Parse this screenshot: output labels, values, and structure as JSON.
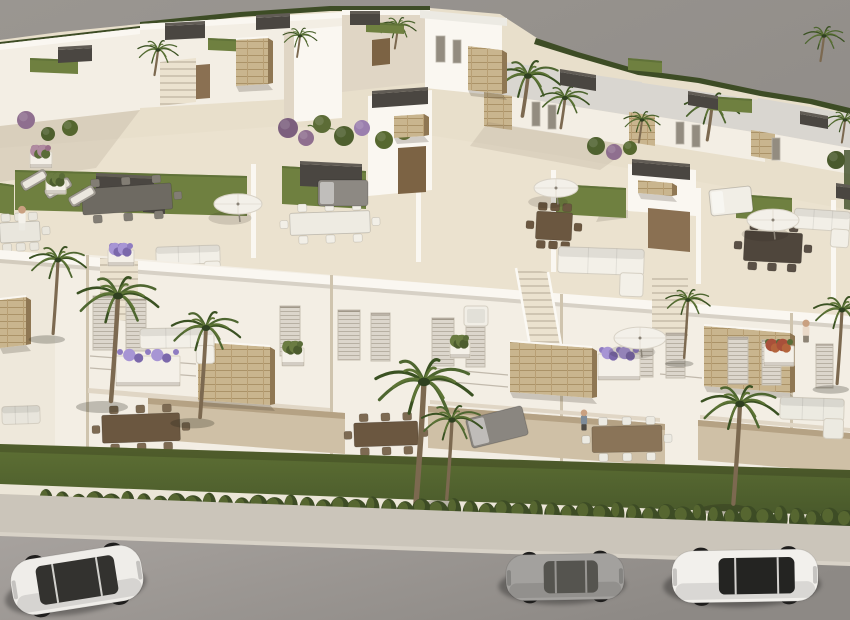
{
  "scene": {
    "description": "Aerial 3D architectural render of a modern white residential development with rooftop terraces, gardens, palm trees and three cars parked on the street below",
    "palette": {
      "bg1": "#9a9691",
      "bg2": "#8b8783",
      "base": "#e8dfcb",
      "wall": "#f3eee4",
      "wallBright": "#faf7f1",
      "wallShadow": "#e0d6c5",
      "wallDark": "#cfc4ae",
      "wedge": "#eee8db",
      "roof": "#d9d6d0",
      "roofEdge": "#eceae3",
      "boxDark": "#4a4641",
      "boxDark2": "#615c55",
      "stone": "#c9b58e",
      "stoneLine": "#ab9368",
      "stoneLine2": "#b89f74",
      "stoneSide": "#8f7753",
      "lawn": "#6f8040",
      "lawnEdge": "#5a6c34",
      "garden1": "#5e7034",
      "garden2": "#47572a",
      "hedge": "#3d4c25",
      "hedgeLight": "#5a6b33",
      "palm1": "#4e6630",
      "palm2": "#3a5122",
      "palm3": "#5d7435",
      "trunk": "#7c6950",
      "floor": "#ebe2cf",
      "stepLine": "#cfc5b2",
      "recess": "#cfc0a6",
      "recessDark": "#b5a284",
      "doorway": "#8a7052",
      "doorway2": "#7c6344",
      "win": "#dcd6cc",
      "winLine": "#b7b0a3",
      "winDark": "#938c80",
      "umbrella": "#f3f0e9",
      "umbrellaEdge": "#d8d2c6",
      "pole": "#8a8377",
      "whiteFurn": "#f1ede4",
      "grayFurn": "#8a8680",
      "wood": "#6b5740",
      "flowerPurple": "#8f7cc1",
      "flowerLight": "#a795d4",
      "flowerRed": "#a8503a",
      "potGreen": "#5a6c38",
      "road1": "#a7a29e",
      "road2": "#8d8985",
      "walk": "#cbc5ba",
      "curb": "#d8d2c7",
      "lowWall": "#ece6d8",
      "skin": "#c9a080"
    }
  },
  "objects": {
    "lawns": [
      {
        "x": 15,
        "y": 170,
        "w": 232,
        "h": 40,
        "dy": 6
      },
      {
        "x": 282,
        "y": 166,
        "w": 84,
        "h": 38,
        "dy": 5
      },
      {
        "x": 556,
        "y": 184,
        "w": 70,
        "h": 30,
        "dy": 4
      },
      {
        "x": 736,
        "y": 194,
        "w": 56,
        "h": 24,
        "dy": 4
      },
      {
        "x": 0,
        "y": 183,
        "w": 14,
        "h": 30,
        "dy": 2
      },
      {
        "x": 30,
        "y": 58,
        "w": 48,
        "h": 14,
        "dy": 2
      },
      {
        "x": 208,
        "y": 38,
        "w": 42,
        "h": 12,
        "dy": 2
      },
      {
        "x": 366,
        "y": 22,
        "w": 38,
        "h": 10,
        "dy": 2
      },
      {
        "x": 708,
        "y": 96,
        "w": 44,
        "h": 14,
        "dy": 3
      },
      {
        "x": 628,
        "y": 58,
        "w": 34,
        "h": 12,
        "dy": 3
      }
    ],
    "roof_boxes": [
      {
        "x": 96,
        "y": 176,
        "w": 58,
        "h": 18,
        "dy": 3
      },
      {
        "x": 143,
        "y": 200,
        "w": 22,
        "h": 12,
        "dy": 2
      },
      {
        "x": 300,
        "y": 164,
        "w": 62,
        "h": 22,
        "dy": 3
      },
      {
        "x": 372,
        "y": 94,
        "w": 56,
        "h": 14,
        "dy": -4
      },
      {
        "x": 632,
        "y": 162,
        "w": 58,
        "h": 13,
        "dy": 5
      },
      {
        "x": 165,
        "y": 26,
        "w": 40,
        "h": 14,
        "dy": -2
      },
      {
        "x": 256,
        "y": 18,
        "w": 34,
        "h": 12,
        "dy": -2
      },
      {
        "x": 58,
        "y": 50,
        "w": 34,
        "h": 13,
        "dy": -2
      },
      {
        "x": 350,
        "y": 14,
        "w": 30,
        "h": 11,
        "dy": 0
      },
      {
        "x": 560,
        "y": 72,
        "w": 36,
        "h": 13,
        "dy": 6
      },
      {
        "x": 688,
        "y": 94,
        "w": 30,
        "h": 11,
        "dy": 5
      },
      {
        "x": 800,
        "y": 114,
        "w": 28,
        "h": 10,
        "dy": 5
      },
      {
        "x": 836,
        "y": 186,
        "w": 14,
        "h": 12,
        "dy": 2
      }
    ],
    "stone_boxes": [
      {
        "x": 198,
        "y": 342,
        "w": 72,
        "h": 58,
        "dy": 5
      },
      {
        "x": 510,
        "y": 342,
        "w": 82,
        "h": 50,
        "dy": 6
      },
      {
        "x": 704,
        "y": 326,
        "w": 86,
        "h": 60,
        "dy": 7
      },
      {
        "x": 236,
        "y": 40,
        "w": 32,
        "h": 46,
        "dy": -2
      },
      {
        "x": 394,
        "y": 116,
        "w": 30,
        "h": 22,
        "dy": -2
      },
      {
        "x": 638,
        "y": 180,
        "w": 34,
        "h": 13,
        "dy": 3
      },
      {
        "x": 468,
        "y": 46,
        "w": 34,
        "h": 44,
        "dy": 4
      },
      {
        "x": 0,
        "y": 300,
        "w": 26,
        "h": 48,
        "dy": -3
      }
    ],
    "windows": [
      {
        "x": 93,
        "y": 296,
        "w": 22,
        "h": 54
      },
      {
        "x": 126,
        "y": 299,
        "w": 20,
        "h": 52
      },
      {
        "x": 280,
        "y": 306,
        "w": 20,
        "h": 50
      },
      {
        "x": 338,
        "y": 310,
        "w": 22,
        "h": 50
      },
      {
        "x": 371,
        "y": 313,
        "w": 19,
        "h": 48
      },
      {
        "x": 432,
        "y": 318,
        "w": 22,
        "h": 48
      },
      {
        "x": 466,
        "y": 321,
        "w": 19,
        "h": 46
      },
      {
        "x": 633,
        "y": 330,
        "w": 20,
        "h": 47
      },
      {
        "x": 666,
        "y": 333,
        "w": 19,
        "h": 45
      },
      {
        "x": 728,
        "y": 337,
        "w": 20,
        "h": 47
      },
      {
        "x": 762,
        "y": 340,
        "w": 19,
        "h": 45
      },
      {
        "x": 816,
        "y": 344,
        "w": 17,
        "h": 44
      },
      {
        "x": 436,
        "y": 36,
        "w": 9,
        "h": 26,
        "t": "dark"
      },
      {
        "x": 453,
        "y": 40,
        "w": 8,
        "h": 23,
        "t": "dark"
      },
      {
        "x": 532,
        "y": 102,
        "w": 8,
        "h": 24,
        "t": "dark"
      },
      {
        "x": 548,
        "y": 105,
        "w": 8,
        "h": 24,
        "t": "dark"
      },
      {
        "x": 676,
        "y": 122,
        "w": 8,
        "h": 22,
        "t": "dark"
      },
      {
        "x": 692,
        "y": 125,
        "w": 8,
        "h": 22,
        "t": "dark"
      },
      {
        "x": 772,
        "y": 138,
        "w": 8,
        "h": 22,
        "t": "dark"
      }
    ],
    "planters": [
      {
        "x": 116,
        "y": 356,
        "w": 64,
        "h": 30,
        "flower": "purple"
      },
      {
        "x": 598,
        "y": 354,
        "w": 42,
        "h": 26,
        "flower": "purple"
      },
      {
        "x": 764,
        "y": 346,
        "w": 30,
        "h": 20,
        "flower": "red"
      },
      {
        "x": 282,
        "y": 348,
        "w": 22,
        "h": 18,
        "flower": "green"
      },
      {
        "x": 450,
        "y": 342,
        "w": 20,
        "h": 16,
        "flower": "green"
      },
      {
        "x": 108,
        "y": 250,
        "w": 26,
        "h": 16,
        "flower": "purple"
      },
      {
        "x": 46,
        "y": 180,
        "w": 20,
        "h": 14,
        "flower": "green"
      },
      {
        "x": 30,
        "y": 152,
        "w": 22,
        "h": 16,
        "flower": "pink"
      }
    ],
    "shrubs": [
      {
        "x": 288,
        "y": 128,
        "r": 10,
        "c": "#7c5f7e"
      },
      {
        "x": 306,
        "y": 138,
        "r": 8,
        "c": "#8f6f8f"
      },
      {
        "x": 322,
        "y": 124,
        "r": 9,
        "c": "#5c6c36"
      },
      {
        "x": 344,
        "y": 136,
        "r": 10,
        "c": "#4e5f2e"
      },
      {
        "x": 362,
        "y": 128,
        "r": 8,
        "c": "#9b7fae"
      },
      {
        "x": 384,
        "y": 140,
        "r": 9,
        "c": "#56682f"
      },
      {
        "x": 404,
        "y": 132,
        "r": 8,
        "c": "#6d7b3c"
      },
      {
        "x": 596,
        "y": 146,
        "r": 9,
        "c": "#4f612f"
      },
      {
        "x": 614,
        "y": 152,
        "r": 8,
        "c": "#8f6f8f"
      },
      {
        "x": 630,
        "y": 148,
        "r": 7,
        "c": "#56682f"
      },
      {
        "x": 836,
        "y": 160,
        "r": 9,
        "c": "#4a5a2c"
      },
      {
        "x": 70,
        "y": 128,
        "r": 8,
        "c": "#55662f"
      },
      {
        "x": 26,
        "y": 120,
        "r": 9,
        "c": "#8f6f8f"
      },
      {
        "x": 48,
        "y": 134,
        "r": 7,
        "c": "#4e5f2e"
      }
    ],
    "furniture": [
      {
        "t": "dining",
        "x": 82,
        "y": 186,
        "w": 90,
        "h": 26,
        "rot": -4,
        "table": "#6e6a62",
        "chair": "#827d74",
        "layer": "roof"
      },
      {
        "t": "lounger",
        "x": 20,
        "y": 174,
        "rot": -30,
        "layer": "roof"
      },
      {
        "t": "lounger",
        "x": 44,
        "y": 182,
        "rot": -30,
        "layer": "roof"
      },
      {
        "t": "lounger",
        "x": 68,
        "y": 190,
        "rot": -30,
        "layer": "roof"
      },
      {
        "t": "dining",
        "x": 290,
        "y": 212,
        "w": 80,
        "h": 22,
        "rot": -2,
        "table": "#eeebe2",
        "chair": "#f2efe7",
        "layer": "roof"
      },
      {
        "t": "sofa",
        "x": 156,
        "y": 246,
        "w": 64,
        "h": 18,
        "rot": -2,
        "color": "#f2efe7",
        "layer": "roof"
      },
      {
        "t": "daybed",
        "x": 318,
        "y": 180,
        "w": 50,
        "h": 26,
        "rot": 0,
        "color": "#8d8983",
        "layer": "roof"
      },
      {
        "t": "dining",
        "x": 536,
        "y": 212,
        "w": 36,
        "h": 28,
        "rot": 3,
        "table": "#6b5740",
        "chair": "#6b5740",
        "layer": "roof"
      },
      {
        "t": "sofa",
        "x": 558,
        "y": 248,
        "w": 86,
        "h": 26,
        "rot": 2,
        "color": "#f3f0e8",
        "layer": "roof"
      },
      {
        "t": "daybed",
        "x": 710,
        "y": 188,
        "w": 42,
        "h": 26,
        "rot": -6,
        "color": "#f1eee6",
        "layer": "roof"
      },
      {
        "t": "dining",
        "x": 744,
        "y": 232,
        "w": 58,
        "h": 30,
        "rot": 3,
        "table": "#4f463c",
        "chair": "#5a5046",
        "layer": "roof"
      },
      {
        "t": "sofa",
        "x": 794,
        "y": 210,
        "w": 56,
        "h": 20,
        "rot": 4,
        "color": "#f2efe7",
        "layer": "roof"
      },
      {
        "t": "dining",
        "x": 0,
        "y": 222,
        "w": 40,
        "h": 20,
        "rot": -3,
        "table": "#e9e6dd",
        "chair": "#e9e6dd",
        "layer": "roof"
      },
      {
        "t": "sofa",
        "x": 140,
        "y": 328,
        "w": 74,
        "h": 20,
        "rot": -1,
        "color": "#f2efe7",
        "layer": "ground"
      },
      {
        "t": "armchair",
        "x": 464,
        "y": 306,
        "w": 24,
        "h": 20,
        "color": "#f1eee6",
        "layer": "ground"
      },
      {
        "t": "dining",
        "x": 102,
        "y": 414,
        "w": 78,
        "h": 28,
        "rot": -2,
        "table": "#6b5740",
        "chair": "#7d6a52",
        "layer": "ground"
      },
      {
        "t": "dining",
        "x": 354,
        "y": 422,
        "w": 64,
        "h": 24,
        "rot": -2,
        "table": "#6b5740",
        "chair": "#7d6a52",
        "layer": "ground"
      },
      {
        "t": "daybed",
        "x": 468,
        "y": 412,
        "w": 58,
        "h": 30,
        "rot": -14,
        "color": "#8a8680",
        "layer": "ground"
      },
      {
        "t": "dining",
        "x": 592,
        "y": 426,
        "w": 70,
        "h": 26,
        "rot": -1,
        "table": "#8a7458",
        "chair": "#eceae2",
        "layer": "ground"
      },
      {
        "t": "sofa",
        "x": 780,
        "y": 398,
        "w": 64,
        "h": 22,
        "rot": 2,
        "color": "#eceae1",
        "layer": "ground"
      },
      {
        "t": "sofa",
        "x": 2,
        "y": 406,
        "w": 38,
        "h": 18,
        "rot": -2,
        "color": "#e8e5dc",
        "layer": "ground"
      }
    ],
    "umbrellas": [
      {
        "x": 238,
        "y": 204,
        "r": 24,
        "layer": "roof"
      },
      {
        "x": 556,
        "y": 188,
        "r": 22,
        "layer": "roof"
      },
      {
        "x": 773,
        "y": 220,
        "r": 26,
        "layer": "roof"
      },
      {
        "x": 640,
        "y": 338,
        "r": 26,
        "layer": "ground"
      }
    ],
    "palms": [
      {
        "x": 158,
        "y": 50,
        "s": 0.5,
        "layer": "back"
      },
      {
        "x": 300,
        "y": 36,
        "s": 0.42,
        "layer": "back"
      },
      {
        "x": 398,
        "y": 26,
        "s": 0.45,
        "layer": "back"
      },
      {
        "x": 528,
        "y": 76,
        "s": 0.8,
        "layer": "back"
      },
      {
        "x": 565,
        "y": 98,
        "s": 0.6,
        "layer": "back"
      },
      {
        "x": 712,
        "y": 106,
        "s": 0.68,
        "layer": "back"
      },
      {
        "x": 824,
        "y": 36,
        "s": 0.5,
        "layer": "back"
      },
      {
        "x": 845,
        "y": 120,
        "s": 0.45,
        "layer": "back"
      },
      {
        "x": 318,
        "y": 134,
        "s": 0.5,
        "layer": "back"
      },
      {
        "x": 642,
        "y": 120,
        "s": 0.45,
        "layer": "back"
      },
      {
        "x": 118,
        "y": 296,
        "s": 1.0,
        "layer": "garden"
      },
      {
        "x": 206,
        "y": 328,
        "s": 0.85,
        "layer": "garden"
      },
      {
        "x": 424,
        "y": 382,
        "s": 1.2,
        "layer": "garden"
      },
      {
        "x": 452,
        "y": 420,
        "s": 0.75,
        "layer": "garden"
      },
      {
        "x": 740,
        "y": 404,
        "s": 0.95,
        "layer": "garden"
      },
      {
        "x": 58,
        "y": 260,
        "s": 0.7,
        "layer": "garden"
      },
      {
        "x": 688,
        "y": 300,
        "s": 0.55,
        "layer": "garden"
      },
      {
        "x": 842,
        "y": 310,
        "s": 0.7,
        "layer": "garden"
      }
    ],
    "hedge": {
      "x0": 46,
      "x1": 846,
      "y0": 516,
      "y1": 534,
      "n": 50
    },
    "people": [
      {
        "x": 22,
        "y": 230,
        "h": 26,
        "shirt": "#f4f1ea",
        "legs": "#eceae2",
        "layer": "roof"
      },
      {
        "x": 806,
        "y": 342,
        "h": 24,
        "shirt": "#ead9c8",
        "legs": "#8d8374",
        "layer": "ground"
      },
      {
        "x": 584,
        "y": 430,
        "h": 22,
        "shirt": "#7d8b99",
        "legs": "#4e4a44",
        "layer": "ground"
      }
    ],
    "cars": [
      {
        "name": "white-suv",
        "cx": 77,
        "cy": 580,
        "len": 132,
        "wid": 56,
        "rot": -9,
        "body": "#efede9",
        "glass": "#33322f",
        "cab": "suv"
      },
      {
        "name": "silver-coupe",
        "cx": 565,
        "cy": 577,
        "len": 118,
        "wid": 46,
        "rot": -1,
        "body": "#a3a19e",
        "glass": "#55544f",
        "cab": "coupe"
      },
      {
        "name": "white-sedan",
        "cx": 745,
        "cy": 576,
        "len": 146,
        "wid": 52,
        "rot": -1,
        "body": "#f2f0ec",
        "glass": "#242422",
        "cab": "sedan"
      }
    ]
  }
}
